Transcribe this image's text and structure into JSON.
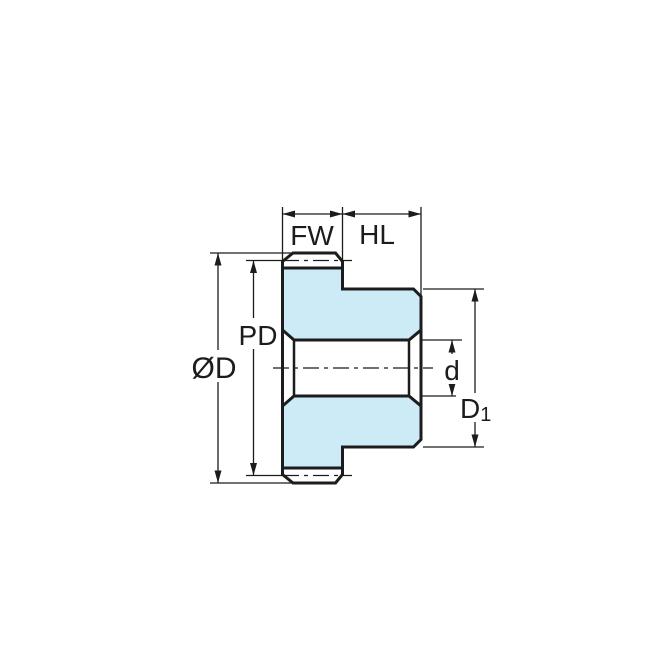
{
  "diagram": {
    "labels": {
      "face_width": "FW",
      "hub_length": "HL",
      "outside_diameter": "ØD",
      "pitch_diameter": "PD",
      "bore_diameter": "d",
      "hub_diameter_main": "D",
      "hub_diameter_sub": "1"
    },
    "colors": {
      "gear_fill": "#cdeaf7",
      "outline": "#1c1c1c",
      "background": "#ffffff"
    }
  }
}
